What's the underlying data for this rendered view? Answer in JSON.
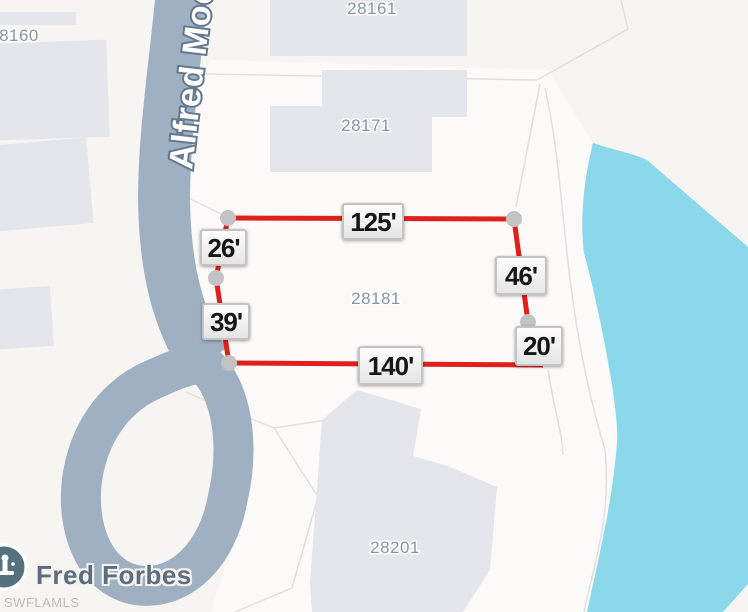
{
  "watermark": {
    "label": "SWFLAMLS"
  },
  "road": {
    "name": "Alfred Moo"
  },
  "poi": {
    "name": "Fred Forbes"
  },
  "parcels": {
    "p28160": "28160",
    "p28161": "28161",
    "p28171": "28171",
    "p28181": "28181",
    "p28201": "28201"
  },
  "measurements": {
    "top": "125'",
    "upper_left": "26'",
    "lower_left": "39'",
    "right_upper": "46'",
    "right_lower": "20'",
    "bottom": "140'"
  },
  "colors": {
    "boundary_red": "#df201c",
    "water_blue": "#8ad8ea",
    "road_gray": "#9fb0c2",
    "vertex_gray": "#c3c3c5"
  }
}
